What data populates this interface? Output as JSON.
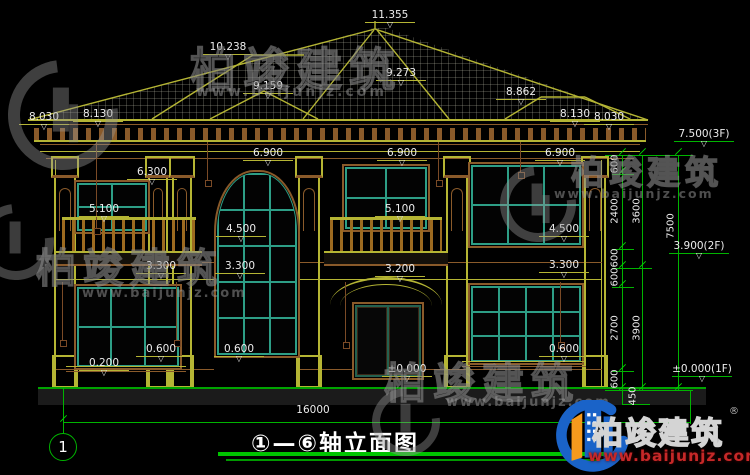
{
  "title": {
    "range": "①—⑥",
    "name": "轴立面图"
  },
  "bottom": {
    "axis_bubble": "1"
  },
  "watermark": {
    "company": "柏竣建筑",
    "url": "www.baijunjz.com"
  },
  "branding": {
    "company": "柏竣建筑",
    "reg": "®",
    "url": "www.baijunjz.com"
  },
  "colors": {
    "dim_green": "#00b400",
    "cad_yellow": "#b5b534",
    "cad_brown": "#8a5a2a",
    "window_teal": "#2d9e86",
    "brand_blue": "#1a63c8",
    "brand_orange": "#f59a1d",
    "brand_red": "#c62828"
  },
  "annotations": [
    {
      "text": "11.355",
      "x": 390,
      "y": 10,
      "kind": "level"
    },
    {
      "text": "10.238",
      "x": 228,
      "y": 42,
      "kind": "level"
    },
    {
      "text": "9.159",
      "x": 268,
      "y": 81,
      "kind": "level"
    },
    {
      "text": "9.273",
      "x": 401,
      "y": 68,
      "kind": "level"
    },
    {
      "text": "8.862",
      "x": 521,
      "y": 87,
      "kind": "level"
    },
    {
      "text": "8.030",
      "x": 44,
      "y": 112,
      "kind": "level"
    },
    {
      "text": "8.130",
      "x": 98,
      "y": 109,
      "kind": "level"
    },
    {
      "text": "8.130",
      "x": 575,
      "y": 109,
      "kind": "level"
    },
    {
      "text": "8.030",
      "x": 609,
      "y": 112,
      "kind": "level"
    },
    {
      "text": "6.900",
      "x": 268,
      "y": 148,
      "kind": "level"
    },
    {
      "text": "6.900",
      "x": 402,
      "y": 148,
      "kind": "level"
    },
    {
      "text": "6.900",
      "x": 560,
      "y": 148,
      "kind": "level"
    },
    {
      "text": "6.300",
      "x": 152,
      "y": 167,
      "kind": "level"
    },
    {
      "text": "5.100",
      "x": 104,
      "y": 204,
      "kind": "level"
    },
    {
      "text": "5.100",
      "x": 400,
      "y": 204,
      "kind": "level"
    },
    {
      "text": "4.500",
      "x": 241,
      "y": 224,
      "kind": "level"
    },
    {
      "text": "4.500",
      "x": 564,
      "y": 224,
      "kind": "level"
    },
    {
      "text": "3.300",
      "x": 161,
      "y": 261,
      "kind": "level"
    },
    {
      "text": "3.300",
      "x": 240,
      "y": 261,
      "kind": "level"
    },
    {
      "text": "3.300",
      "x": 564,
      "y": 260,
      "kind": "level"
    },
    {
      "text": "3.200",
      "x": 400,
      "y": 264,
      "kind": "level"
    },
    {
      "text": "0.200",
      "x": 104,
      "y": 358,
      "kind": "level"
    },
    {
      "text": "0.600",
      "x": 161,
      "y": 344,
      "kind": "level"
    },
    {
      "text": "0.600",
      "x": 239,
      "y": 344,
      "kind": "level"
    },
    {
      "text": "0.600",
      "x": 564,
      "y": 344,
      "kind": "level"
    },
    {
      "text": "±0.000",
      "x": 407,
      "y": 364,
      "kind": "level"
    },
    {
      "text": "7.500(3F)",
      "x": 704,
      "y": 129,
      "kind": "glevel"
    },
    {
      "text": "3.900(2F)",
      "x": 699,
      "y": 241,
      "kind": "glevel"
    },
    {
      "text": "±0.000(1F)",
      "x": 702,
      "y": 364,
      "kind": "glevel"
    },
    {
      "text": "600",
      "x": 615,
      "y": 164,
      "kind": "vdim"
    },
    {
      "text": "2400",
      "x": 615,
      "y": 211,
      "kind": "vdim"
    },
    {
      "text": "3600",
      "x": 637,
      "y": 211,
      "kind": "vdim"
    },
    {
      "text": "7500",
      "x": 671,
      "y": 226,
      "kind": "vdim"
    },
    {
      "text": "600",
      "x": 615,
      "y": 258,
      "kind": "vdim"
    },
    {
      "text": "600",
      "x": 615,
      "y": 277,
      "kind": "vdim"
    },
    {
      "text": "2700",
      "x": 615,
      "y": 328,
      "kind": "vdim"
    },
    {
      "text": "3900",
      "x": 637,
      "y": 328,
      "kind": "vdim"
    },
    {
      "text": "600",
      "x": 615,
      "y": 379,
      "kind": "vdim"
    },
    {
      "text": "450",
      "x": 633,
      "y": 396,
      "kind": "vdim"
    },
    {
      "text": "16000",
      "x": 313,
      "y": 404,
      "kind": "plain"
    }
  ]
}
